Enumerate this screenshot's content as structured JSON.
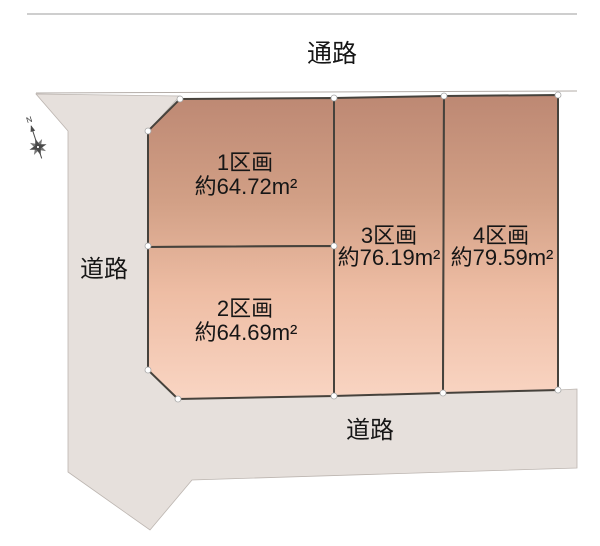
{
  "map": {
    "passage_label": "通路",
    "left_road_label": "道路",
    "bottom_road_label": "道路",
    "compass": {
      "north_label": "N"
    },
    "lots": [
      {
        "name": "1区画",
        "area": "約64.72m²"
      },
      {
        "name": "2区画",
        "area": "約64.69m²"
      },
      {
        "name": "3区画",
        "area": "約76.19m²"
      },
      {
        "name": "4区画",
        "area": "約79.59m²"
      }
    ],
    "colors": {
      "road_fill": "#e6e0dc",
      "lot_border": "#46423c",
      "text": "#161616",
      "top_line": "#9c9c9c",
      "lot_gradient": [
        "#bd8873",
        "#d2a086",
        "#eebda4",
        "#f9d5c3"
      ]
    }
  }
}
